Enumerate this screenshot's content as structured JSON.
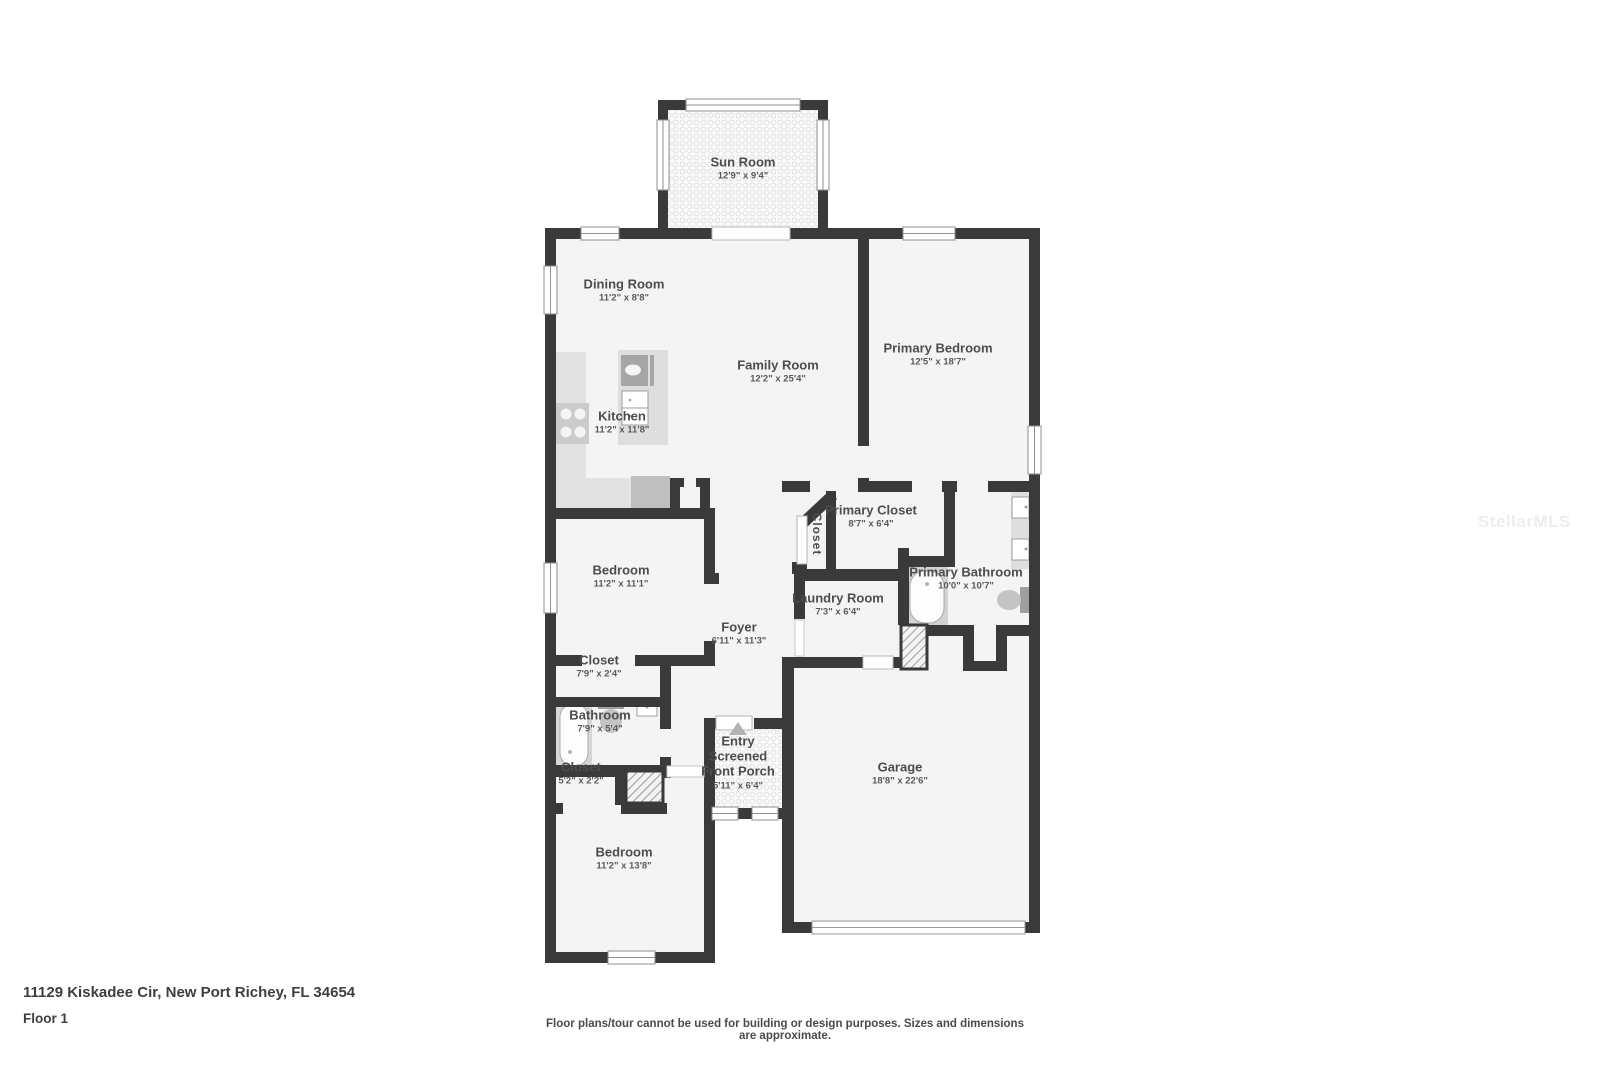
{
  "meta": {
    "address": "11129 Kiskadee Cir, New Port Richey, FL 34654",
    "floor_label": "Floor 1",
    "disclaimer": "Floor plans/tour cannot be used for building or design purposes. Sizes and dimensions are approximate.",
    "watermark": "StellarMLS"
  },
  "colors": {
    "wall": "#3a3a3a",
    "room_fill": "#f4f4f5",
    "fixture_gray": "#d6d6d6",
    "label_text": "#4d4d4d"
  },
  "rooms": [
    {
      "name": "Sun Room",
      "dims": "12'9\" x 9'4\""
    },
    {
      "name": "Dining Room",
      "dims": "11'2\" x 8'8\""
    },
    {
      "name": "Family Room",
      "dims": "12'2\" x 25'4\""
    },
    {
      "name": "Primary Bedroom",
      "dims": "12'5\" x 18'7\""
    },
    {
      "name": "Kitchen",
      "dims": "11'2\" x 11'8\""
    },
    {
      "name": "Primary Closet",
      "dims": "8'7\" x 6'4\""
    },
    {
      "name": "Closet",
      "dims": ""
    },
    {
      "name": "Laundry Room",
      "dims": "7'3\" x 6'4\""
    },
    {
      "name": "Primary Bathroom",
      "dims": "10'0\" x 10'7\""
    },
    {
      "name": "Bedroom",
      "dims": "11'2\" x 11'1\""
    },
    {
      "name": "Foyer",
      "dims": "6'11\" x 11'3\""
    },
    {
      "name": "Closet",
      "dims": "7'9\" x 2'4\""
    },
    {
      "name": "Bathroom",
      "dims": "7'9\" x 5'4\""
    },
    {
      "name": "Closet",
      "dims": "5'2\" x 2'2\""
    },
    {
      "name": "Entry",
      "dims": ""
    },
    {
      "name": "Screened Front Porch",
      "dims": "5'11\" x 6'4\""
    },
    {
      "name": "Garage",
      "dims": "18'8\" x 22'6\""
    },
    {
      "name": "Bedroom",
      "dims": "11'2\" x 13'8\""
    }
  ]
}
